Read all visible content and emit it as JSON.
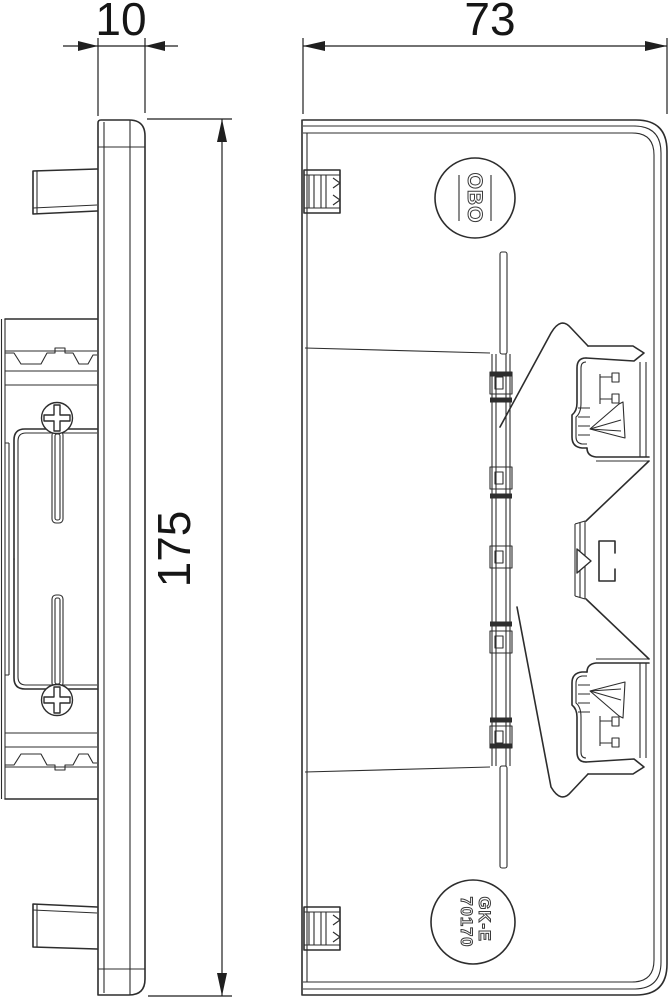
{
  "drawing": {
    "background_color": "#ffffff",
    "line_color": "#2d2d2d",
    "dimensions": {
      "side_view_width": "10",
      "front_view_width": "73",
      "overall_height": "175"
    },
    "logo_text": "OBO",
    "part_code": {
      "line1": "GK-E",
      "line2": "70170"
    }
  }
}
